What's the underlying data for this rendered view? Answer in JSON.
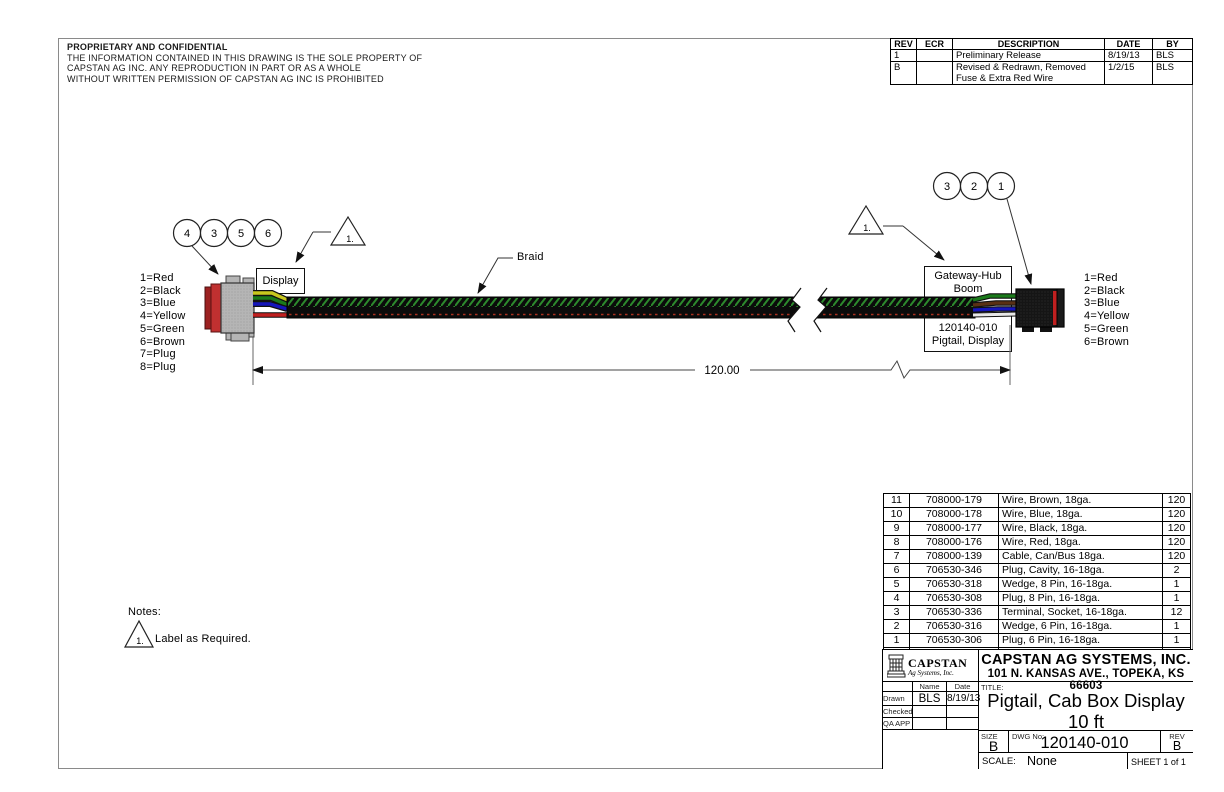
{
  "proprietary": {
    "title": "PROPRIETARY AND CONFIDENTIAL",
    "line1": "THE INFORMATION CONTAINED IN THIS DRAWING IS THE SOLE PROPERTY OF",
    "line2": "CAPSTAN AG INC. ANY REPRODUCTION IN PART OR AS A WHOLE",
    "line3": "WITHOUT WRITTEN PERMISSION OF CAPSTAN AG INC IS PROHIBITED"
  },
  "revision_table": {
    "headers": [
      "REV",
      "ECR",
      "DESCRIPTION",
      "DATE",
      "BY"
    ],
    "rows": [
      {
        "rev": "1",
        "ecr": "",
        "description": "Preliminary Release",
        "date": "8/19/13",
        "by": "BLS"
      },
      {
        "rev": "B",
        "ecr": "",
        "description": "Revised & Redrawn, Removed Fuse & Extra Red Wire",
        "date": "1/2/15",
        "by": "BLS"
      }
    ]
  },
  "diagram": {
    "left_balloons": [
      "4",
      "3",
      "5",
      "6"
    ],
    "right_balloons": [
      "3",
      "2",
      "1"
    ],
    "left_flag": "1.",
    "right_flag": "1.",
    "display_label": "Display",
    "braid_label": "Braid",
    "gateway_line1": "Gateway-Hub",
    "gateway_line2": "Boom",
    "pigtail_line1": "120140-010",
    "pigtail_line2": "Pigtail, Display",
    "dimension": "120.00",
    "left_legend": [
      "1=Red",
      "2=Black",
      "3=Blue",
      "4=Yellow",
      "5=Green",
      "6=Brown",
      "7=Plug",
      "8=Plug"
    ],
    "right_legend": [
      "1=Red",
      "2=Black",
      "3=Blue",
      "4=Yellow",
      "5=Green",
      "6=Brown"
    ]
  },
  "notes": {
    "heading": "Notes:",
    "note1_flag": "1.",
    "note1_text": "Label as Required."
  },
  "bom": {
    "headers": [
      "Item",
      "Part Number",
      "Description",
      "Qty"
    ],
    "rows": [
      [
        "11",
        "708000-179",
        "Wire, Brown, 18ga.",
        "120"
      ],
      [
        "10",
        "708000-178",
        "Wire, Blue, 18ga.",
        "120"
      ],
      [
        "9",
        "708000-177",
        "Wire, Black, 18ga.",
        "120"
      ],
      [
        "8",
        "708000-176",
        "Wire, Red, 18ga.",
        "120"
      ],
      [
        "7",
        "708000-139",
        "Cable, Can/Bus 18ga.",
        "120"
      ],
      [
        "6",
        "706530-346",
        "Plug, Cavity, 16-18ga.",
        "2"
      ],
      [
        "5",
        "706530-318",
        "Wedge, 8 Pin, 16-18ga.",
        "1"
      ],
      [
        "4",
        "706530-308",
        "Plug, 8 Pin, 16-18ga.",
        "1"
      ],
      [
        "3",
        "706530-336",
        "Terminal, Socket, 16-18ga.",
        "12"
      ],
      [
        "2",
        "706530-316",
        "Wedge, 6 Pin, 16-18ga.",
        "1"
      ],
      [
        "1",
        "706530-306",
        "Plug, 6 Pin, 16-18ga.",
        "1"
      ]
    ]
  },
  "title_block": {
    "logo_name": "CAPSTAN",
    "logo_sub": "Ag Systems, Inc.",
    "company": "CAPSTAN AG SYSTEMS, INC.",
    "address": "101 N. KANSAS AVE., TOPEKA, KS 66603",
    "name_header": "Name",
    "date_header": "Date",
    "drawn_label": "Drawn",
    "drawn_name": "BLS",
    "drawn_date": "8/19/13",
    "checked_label": "Checked",
    "qa_label": "QA APP",
    "title_label": "TITLE:",
    "title_line1": "Pigtail, Cab Box Display",
    "title_line2": "10 ft",
    "size_label": "SIZE",
    "size_value": "B",
    "dwg_label": "DWG No:",
    "dwg_value": "120140-010",
    "rev_label": "REV",
    "rev_value": "B",
    "scale_label": "SCALE:",
    "scale_value": "None",
    "sheet": "SHEET 1 of 1"
  },
  "colors": {
    "wire_red": "#c02020",
    "wire_black": "#151515",
    "wire_blue": "#1515bb",
    "wire_yellow": "#c8c81e",
    "wire_green": "#1a7a1a",
    "wire_brown": "#5a3013",
    "braid_hatch_green": "#2d8a2d",
    "cable_body": "#0b0b0b",
    "connector_gray": "#b5b5b5",
    "connector_red_cap": "#c03030"
  }
}
